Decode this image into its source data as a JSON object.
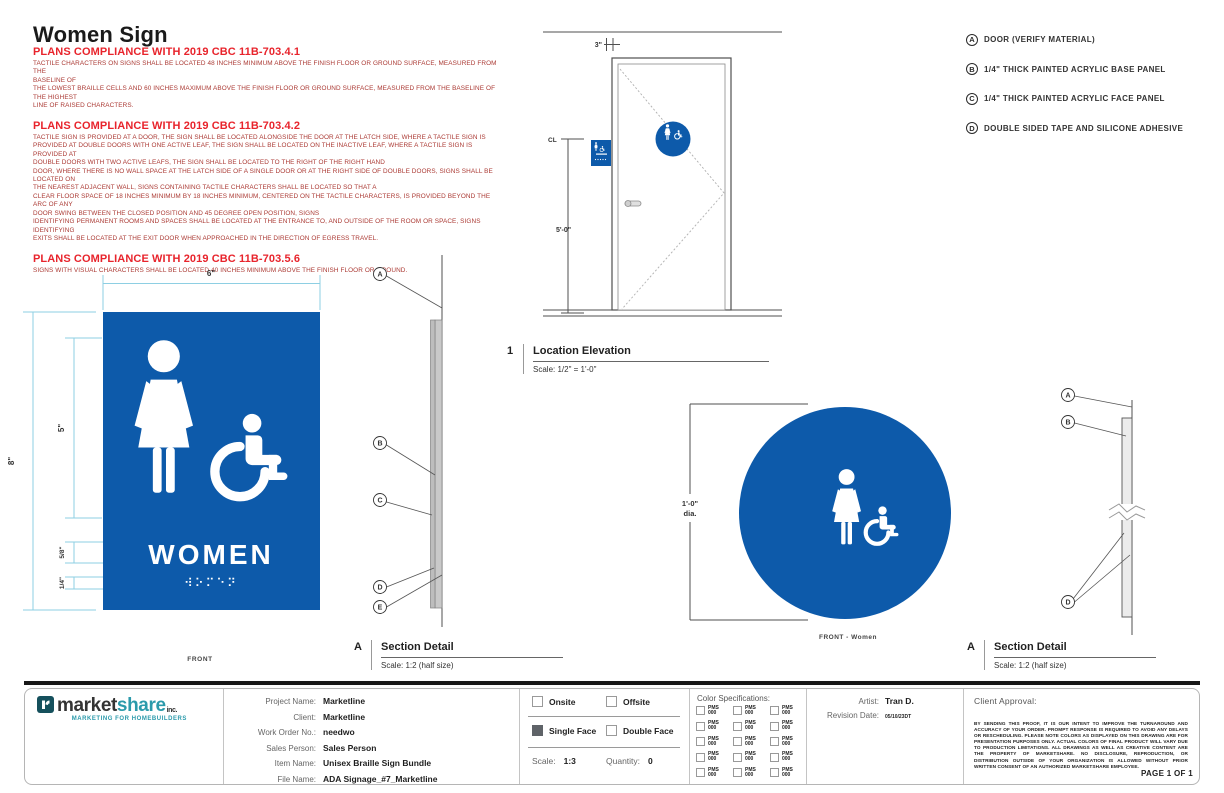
{
  "colors": {
    "sign_blue": "#0d5aaa",
    "dim_line": "#8ecfe3",
    "accent_red": "#e8242c",
    "body_red": "#ab3a34",
    "logo_teal": "#2b9aab",
    "logo_dark": "#333333"
  },
  "title": "Women Sign",
  "compliance_notes": [
    {
      "heading": "PLANS COMPLIANCE WITH 2019 CBC 11B-703.4.1",
      "body": "TACTILE CHARACTERS ON SIGNS SHALL BE LOCATED 48 INCHES MINIMUM ABOVE THE FINISH FLOOR OR GROUND SURFACE, MEASURED FROM THE\nBASELINE OF\nTHE LOWEST BRAILLE CELLS AND 60 INCHES MAXIMUM ABOVE THE FINISH FLOOR OR GROUND SURFACE, MEASURED FROM THE BASELINE OF THE HIGHEST\nLINE OF RAISED CHARACTERS."
    },
    {
      "heading": "PLANS COMPLIANCE WITH 2019 CBC 11B-703.4.2",
      "body": "TACTILE SIGN IS PROVIDED AT A DOOR, THE SIGN SHALL BE LOCATED ALONGSIDE THE DOOR AT THE LATCH SIDE, WHERE A TACTILE SIGN IS\nPROVIDED AT DOUBLE DOORS WITH ONE ACTIVE LEAF, THE SIGN SHALL BE LOCATED ON THE INACTIVE LEAF, WHERE A TACTILE SIGN IS PROVIDED AT\nDOUBLE DOORS WITH TWO ACTIVE LEAFS, THE SIGN SHALL BE LOCATED TO THE RIGHT OF THE RIGHT HAND\nDOOR, WHERE THERE IS NO WALL SPACE AT THE LATCH SIDE OF A SINGLE DOOR OR AT THE RIGHT SIDE OF DOUBLE DOORS, SIGNS SHALL BE LOCATED ON\nTHE NEAREST ADJACENT WALL, SIGNS CONTAINING TACTILE CHARACTERS SHALL BE LOCATED SO THAT A\nCLEAR FLOOR SPACE OF 18 INCHES MINIMUM BY 18 INCHES MINIMUM, CENTERED ON THE TACTILE CHARACTERS, IS PROVIDED BEYOND THE ARC OF ANY\nDOOR SWING BETWEEN THE CLOSED POSITION AND 45 DEGREE OPEN POSITION, SIGNS\nIDENTIFYING PERMANENT ROOMS AND SPACES SHALL BE LOCATED AT THE ENTRANCE TO, AND OUTSIDE OF THE ROOM OR SPACE, SIGNS IDENTIFYING\nEXITS SHALL BE LOCATED AT THE EXIT DOOR WHEN APPROACHED IN THE DIRECTION OF EGRESS TRAVEL."
    },
    {
      "heading": "PLANS COMPLIANCE WITH 2019 CBC 11B-703.5.6",
      "body": "SIGNS WITH VISUAL CHARACTERS SHALL BE LOCATED 40 INCHES MINIMUM ABOVE THE FINISH FLOOR OR GROUND."
    }
  ],
  "legend": [
    {
      "key": "A",
      "label": "DOOR (VERIFY MATERIAL)"
    },
    {
      "key": "B",
      "label": "1/4\" THICK PAINTED ACRYLIC BASE PANEL"
    },
    {
      "key": "C",
      "label": "1/4\" THICK PAINTED ACRYLIC FACE PANEL"
    },
    {
      "key": "D",
      "label": "DOUBLE SIDED TAPE AND SILICONE ADHESIVE"
    }
  ],
  "door_elevation": {
    "offset_dim": "3\"",
    "centerline": "CL",
    "height_dim": "5'-0\""
  },
  "location_elevation": {
    "number": "1",
    "title": "Location Elevation",
    "scale": "Scale: 1/2\" = 1'-0\""
  },
  "front_view": {
    "width_dim": "6\"",
    "height_dim": "8\"",
    "pictogram_dim": "5\"",
    "text_dim": "5/8\"",
    "braille_dim": "1/4\"",
    "sign_text": "WOMEN",
    "braille": "⠺⠕⠍⠑⠝",
    "label": "FRONT"
  },
  "section_detail_left": {
    "number": "A",
    "title": "Section Detail",
    "scale": "Scale: 1:2 (half size)",
    "callouts": {
      "a": "A",
      "b": "B",
      "c": "C",
      "d": "D",
      "e": "E"
    }
  },
  "circle_sign": {
    "dia_line1": "1'-0\"",
    "dia_line2": "dia.",
    "label": "FRONT - Women"
  },
  "section_detail_right": {
    "number": "A",
    "title": "Section Detail",
    "scale": "Scale: 1:2 (half size)",
    "callouts": {
      "a": "A",
      "b": "B",
      "d": "D"
    }
  },
  "title_block": {
    "logo": {
      "word_dark": "market",
      "word_teal": "share",
      "suffix": "inc.",
      "tagline": "MARKETING FOR HOMEBUILDERS"
    },
    "address": [
      "711 CHARCOT AVE., SUITE A",
      "SAN JOSE CA 95131",
      "(408) 262-0677",
      "MARKETSHAREONLINE.COM"
    ],
    "project": [
      {
        "label": "Project Name:",
        "value": "Marketline"
      },
      {
        "label": "Client:",
        "value": "Marketline"
      },
      {
        "label": "Work Order No.:",
        "value": "needwo"
      },
      {
        "label": "Sales Person:",
        "value": "Sales Person"
      },
      {
        "label": "Item Name:",
        "value": "Unisex Braille Sign Bundle"
      },
      {
        "label": "File Name:",
        "value": "ADA Signage_#7_Marketline"
      }
    ],
    "options": {
      "onsite": "Onsite",
      "offsite": "Offsite",
      "single_face": "Single Face",
      "double_face": "Double Face",
      "scale_label": "Scale:",
      "scale_value": "1:3",
      "quantity_label": "Quantity:",
      "quantity_value": "0"
    },
    "color_specs": {
      "heading": "Color Specifications:",
      "swatches": [
        {
          "l1": "PMS",
          "l2": "000"
        },
        {
          "l1": "PMS",
          "l2": "000"
        },
        {
          "l1": "PMS",
          "l2": "000"
        },
        {
          "l1": "PMS",
          "l2": "000"
        },
        {
          "l1": "PMS",
          "l2": "000"
        },
        {
          "l1": "PMS",
          "l2": "000"
        },
        {
          "l1": "PMS",
          "l2": "000"
        },
        {
          "l1": "PMS",
          "l2": "000"
        },
        {
          "l1": "PMS",
          "l2": "000"
        },
        {
          "l1": "PMS",
          "l2": "000"
        },
        {
          "l1": "PMS",
          "l2": "000"
        },
        {
          "l1": "PMS",
          "l2": "000"
        },
        {
          "l1": "PMS",
          "l2": "000"
        },
        {
          "l1": "PMS",
          "l2": "000"
        },
        {
          "l1": "PMS",
          "l2": "000"
        }
      ]
    },
    "artist": {
      "label": "Artist:",
      "value": "Tran D.",
      "revision_label": "Revision Date:",
      "revision_value": "05/10/23DT"
    },
    "approval": {
      "heading": "Client Approval:",
      "fine_print": "BY SENDING THIS PROOF, IT IS OUR INTENT TO IMPROVE THE TURNAROUND AND ACCURACY OF YOUR ORDER. PROMPT RESPONSE IS REQUIRED TO AVOID ANY DELAYS OR RESCHEDULING. PLEASE NOTE COLORS AS DISPLAYED ON THIS DRAWING ARE FOR PRESENTATION PURPOSES ONLY. ACTUAL COLORS OF FINAL PRODUCT WILL VARY DUE TO PRODUCTION LIMITATIONS. ALL DRAWINGS AS WELL AS CREATIVE CONTENT ARE THE PROPERTY OF MARKETSHARE. NO DISCLOSURE, REPRODUCTION, OR DISTRIBUTION OUTSIDE OF YOUR ORGANIZATION IS ALLOWED WITHOUT PRIOR WRITTEN CONSENT OF AN AUTHORIZED MARKETSHARE EMPLOYEE.",
      "page": "PAGE 1 OF 1"
    }
  }
}
